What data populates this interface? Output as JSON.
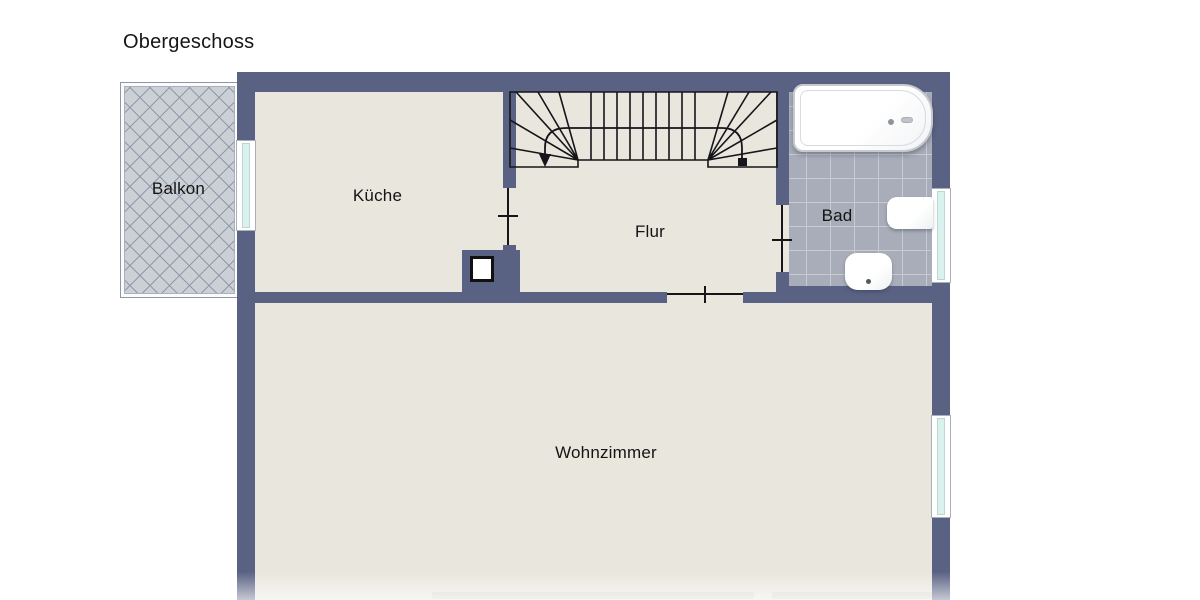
{
  "title": "Obergeschoss",
  "plan": {
    "rooms": {
      "balkon": {
        "label": "Balkon"
      },
      "kueche": {
        "label": "Küche"
      },
      "flur": {
        "label": "Flur"
      },
      "bad": {
        "label": "Bad"
      },
      "wohnzimmer": {
        "label": "Wohnzimmer"
      }
    },
    "fixtures": {
      "staircase": "stairs-with-walk-line-icon",
      "bathtub": "bathtub-icon",
      "toilet": "toilet-icon",
      "washbasin": "washbasin-icon",
      "shaft": "shaft-icon",
      "windows": 3,
      "door_openings": 3
    },
    "colors": {
      "wall": "#5a6284",
      "floor": "#e9e6dd",
      "bath_tiles": "#a8adb9",
      "balcony_tiles": "#cbcfd6",
      "window_glass": "#d9f2ee",
      "outline": "#15151a",
      "background": "#ffffff"
    }
  }
}
